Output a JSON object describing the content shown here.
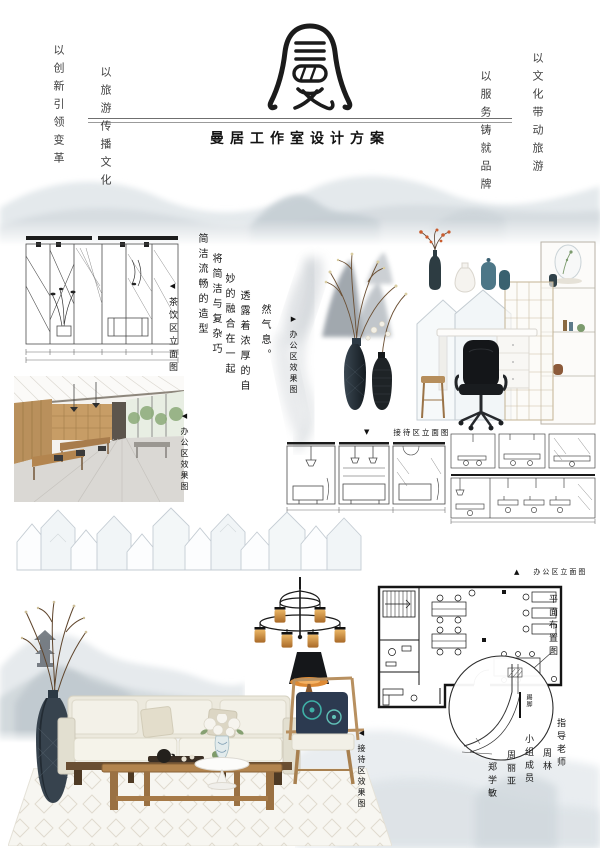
{
  "poster": {
    "logo_char": "曼",
    "title": "曼居工作室设计方案",
    "slogans": {
      "left_outer": "以创新引领变革",
      "left_inner": "以旅游传播文化",
      "right_inner": "以服务铸就品牌",
      "right_outer": "以文化带动旅游"
    },
    "description_columns": [
      "简洁流畅的造型",
      "将简洁与复杂巧",
      "妙的融合在一起",
      "透露着浓厚的自",
      "然气息。"
    ],
    "captions": {
      "dining_elevation": {
        "marker": "◀",
        "text": "茶饮区立面图"
      },
      "office_render_left": {
        "marker": "◀",
        "text": "办公区效果图"
      },
      "office_render_right": {
        "marker": "▶",
        "text": "办公区效果图"
      },
      "reception_elevation": {
        "marker": "▼",
        "text": "接待区立面图"
      },
      "office_elevation": {
        "marker": "▲",
        "text": "办公区立面图"
      },
      "floor_plan": {
        "text": "平面布置图"
      },
      "reception_render": {
        "marker": "◀",
        "text": "接待区效果图"
      },
      "detail_label": {
        "text": "踢脚"
      }
    },
    "credits": {
      "advisor_label": "指导老师",
      "advisor_name": "周林",
      "team_label": "小组成员",
      "member1": "周丽亚",
      "member2": "郑学敏"
    }
  }
}
